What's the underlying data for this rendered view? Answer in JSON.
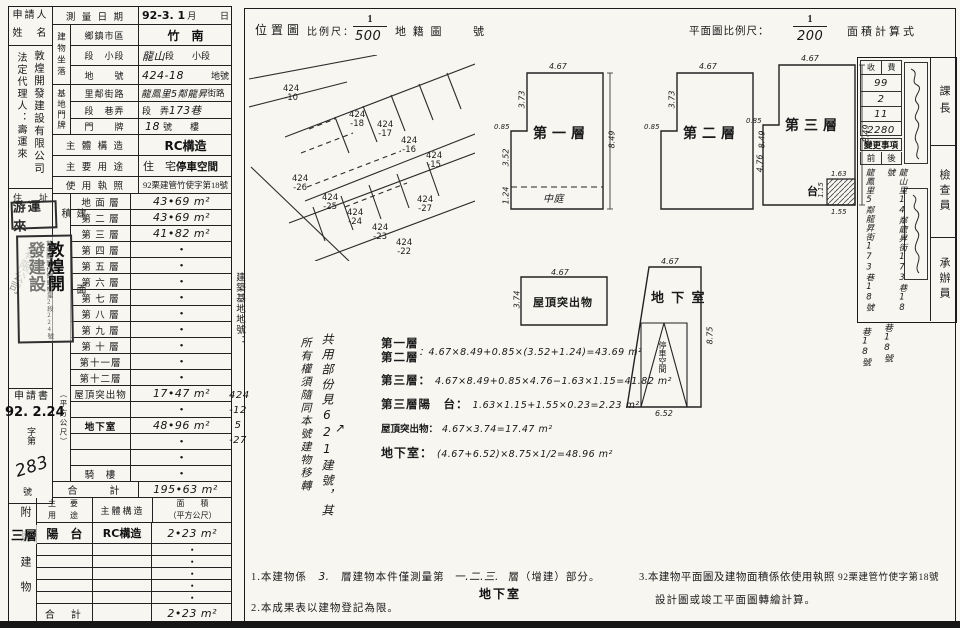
{
  "applicant": {
    "title1": "申請人",
    "title2": "姓　名",
    "company": "敦煌開發建設有限公司",
    "agent": "法定代理人：壽運來",
    "address_label": "住　址",
    "seal_name": "游運來",
    "seal_co_right": "敦煌開",
    "seal_co_left": "發建設",
    "seal_co_addr": "苗栗縣頭份鎮蟠桃里2段224號",
    "seal_faint": "有限公司",
    "application": "申請書",
    "recv_stamp": "92. 2.24",
    "no_prefix": "字第",
    "no_value": "283",
    "no_suffix": "號"
  },
  "survey": {
    "label": "測 量 日 期",
    "stamp": "92-3. 1",
    "month": "月",
    "day": "日"
  },
  "location": {
    "group1": "建物坐落",
    "group2": "基地門牌",
    "rows": [
      {
        "label": "鄉鎮市區",
        "pre": "",
        "hand": "竹　南",
        "post": "",
        "stamp": true
      },
      {
        "label": "段　小段",
        "pre": "",
        "hand": "龍山",
        "post": "段　　小段"
      },
      {
        "label": "地　　號",
        "pre": "",
        "hand": "424-18",
        "post": "　地號"
      },
      {
        "label": "里鄰街路",
        "pre": "",
        "hand": "龍鳳里5鄰龍昇",
        "post": "街路"
      },
      {
        "label": "段　巷弄",
        "pre": "段　弄",
        "hand": "173巷",
        "post": ""
      },
      {
        "label": "門　　牌",
        "pre": "",
        "hand": "18",
        "post": "號　　樓"
      }
    ]
  },
  "structure": {
    "label": "主 體 構 造",
    "value": "RC構造"
  },
  "usage": {
    "label": "主 要 用 途",
    "pre": "住　宅",
    "value": "停車空間"
  },
  "license": {
    "label": "使 用 執 照",
    "value": "92栗建管竹使字第18號"
  },
  "area_section": {
    "col_label_main": "建　面　積",
    "col_label_sub": "（平方公尺）",
    "floors": [
      {
        "label": "地 面 層",
        "value": "43•69 m²",
        "hand": true
      },
      {
        "label": "第 二 層",
        "value": "43•69 m²",
        "hand": true
      },
      {
        "label": "第 三 層",
        "value": "41•82 m²",
        "hand": true
      },
      {
        "label": "第 四 層",
        "value": "•"
      },
      {
        "label": "第 五 層",
        "value": "•"
      },
      {
        "label": "第 六 層",
        "value": "•"
      },
      {
        "label": "第 七 層",
        "value": "•"
      },
      {
        "label": "第 八 層",
        "value": "•"
      },
      {
        "label": "第 九 層",
        "value": "•"
      },
      {
        "label": "第 十 層",
        "value": "•"
      },
      {
        "label": "第十一層",
        "value": "•"
      },
      {
        "label": "第十二層",
        "value": "•"
      },
      {
        "label": "屋頂突出物",
        "value": "17•47 m²",
        "hand": true
      },
      {
        "label": "",
        "value": "•"
      },
      {
        "label": "地下室",
        "value": "48•96 m²",
        "hand": true,
        "stamp": true
      },
      {
        "label": "",
        "value": "•"
      },
      {
        "label": "",
        "value": "•"
      },
      {
        "label": "騎　樓",
        "value": "•"
      }
    ],
    "total_label": "合　　計",
    "total_value": "195•63 m²"
  },
  "annex": {
    "side_label": "附屬建物",
    "floor_hand": "三層",
    "h_use1": "主　要",
    "h_use2": "用　途",
    "h_struct": "主體構造",
    "h_area1": "面　　積",
    "h_area2": "（平方公尺）",
    "row1": {
      "use": "陽　台",
      "struct": "RC構造",
      "area": "2•23 m²"
    },
    "bullets": [
      "•",
      "•",
      "•",
      "•",
      "•"
    ],
    "total_label": "合　計",
    "total_value": "2•23 m²"
  },
  "site_nos": {
    "label": "建築基地地號：",
    "lines": [
      "424",
      "-12",
      "5",
      "-27"
    ]
  },
  "scales": {
    "loc_title": "位置圖",
    "scale_label": "比例尺：",
    "loc_num": "1",
    "loc_den": "500",
    "cad_label": "地 籍 圖",
    "cad_no": "號",
    "plan_label": "平面圖比例尺：",
    "plan_num": "1",
    "plan_den": "200",
    "calc_title": "面積計算式"
  },
  "map": {
    "parcels": [
      {
        "no": "424",
        "sub": "-10",
        "x": 34,
        "y": 30
      },
      {
        "no": "424",
        "sub": "-18",
        "x": 100,
        "y": 56
      },
      {
        "no": "424",
        "sub": "-17",
        "x": 128,
        "y": 66
      },
      {
        "no": "424",
        "sub": "-16",
        "x": 152,
        "y": 82
      },
      {
        "no": "424",
        "sub": "-15",
        "x": 177,
        "y": 97
      },
      {
        "no": "424",
        "sub": "-26",
        "x": 43,
        "y": 120
      },
      {
        "no": "424",
        "sub": "-25",
        "x": 73,
        "y": 139
      },
      {
        "no": "424",
        "sub": "-24",
        "x": 98,
        "y": 154
      },
      {
        "no": "424",
        "sub": "-23",
        "x": 123,
        "y": 169
      },
      {
        "no": "424",
        "sub": "-22",
        "x": 147,
        "y": 184
      },
      {
        "no": "424",
        "sub": "-27",
        "x": 168,
        "y": 141
      }
    ]
  },
  "plans": {
    "floor1": {
      "name": "第一層",
      "top": "4.67",
      "left_upper": "3.73",
      "notch": "0.85",
      "left_mid": "3.52",
      "left_low": "1.24",
      "right": "8.49",
      "court": "中庭"
    },
    "floor2": {
      "name": "第二層",
      "top": "4.67",
      "left_upper": "3.73",
      "notch": "0.85",
      "right": "8.49"
    },
    "floor3": {
      "name": "第三層",
      "top": "4.67",
      "notch": "0.85",
      "left_low": "4.76",
      "right": "8.49",
      "balc_top": "1.63",
      "balc_side": "1.15",
      "balc_bot": "1.55",
      "balc_label": "台"
    },
    "roof": {
      "name": "屋頂突出物",
      "top": "4.67",
      "left": "3.74"
    },
    "basement": {
      "name": "地 下 室",
      "top": "4.67",
      "right": "8.75",
      "bottom": "6.52",
      "inner": "停車空間"
    }
  },
  "calc": {
    "r1a": "第一層",
    "r1b": "第二層",
    "r1f": "：4.67×8.49+0.85×(3.52+1.24)=43.69 m²",
    "r2l": "第三層：",
    "r2f": "4.67×8.49+0.85×4.76−1.63×1.15=41.82 m²",
    "r3l": "第三層陽　台：",
    "r3f": "1.63×1.15+1.55×0.23=2.23 m²",
    "r4l": "屋頂突出物：",
    "r4f": "4.67×3.74=17.47 m²",
    "r5l": "地下室：",
    "r5f": "(4.67+6.52)×8.75×1/2=48.96 m²"
  },
  "shared_note": {
    "col_right": "共用部份見621建號，其",
    "col_left": "所有權須隨同本號建物移轉",
    "arrow": "↗"
  },
  "footnotes": {
    "n1a": "1.本建物係",
    "n1h1": "3.",
    "n1b": "層建物本件僅測量第",
    "n1h2": "一.二.三.",
    "n1c": "層（增建）部分。",
    "n1d": "地下室",
    "n2": "2.本成果表以建物登記為限。",
    "n3a": "3.本建物平面圖及建物面積係依使用執照",
    "n3no": "92栗建管竹使字第18號",
    "n3b": "設計圖或竣工平面圖轉繪計算。"
  },
  "review": {
    "titles": [
      "課長",
      "檢查員",
      "承辦員"
    ],
    "fee_h1": "收",
    "fee_h2": "費",
    "fee_values": [
      "99",
      "2",
      "11",
      "2280"
    ],
    "change_label": "變更事項",
    "before": "前",
    "after": "後",
    "before_addr": "龍鳳里5鄰龍昇街173巷18號",
    "after_addr": "龍山里14鄰龍昇街173巷18號",
    "tail1": "巷18號",
    "tail2": "巷18號"
  }
}
